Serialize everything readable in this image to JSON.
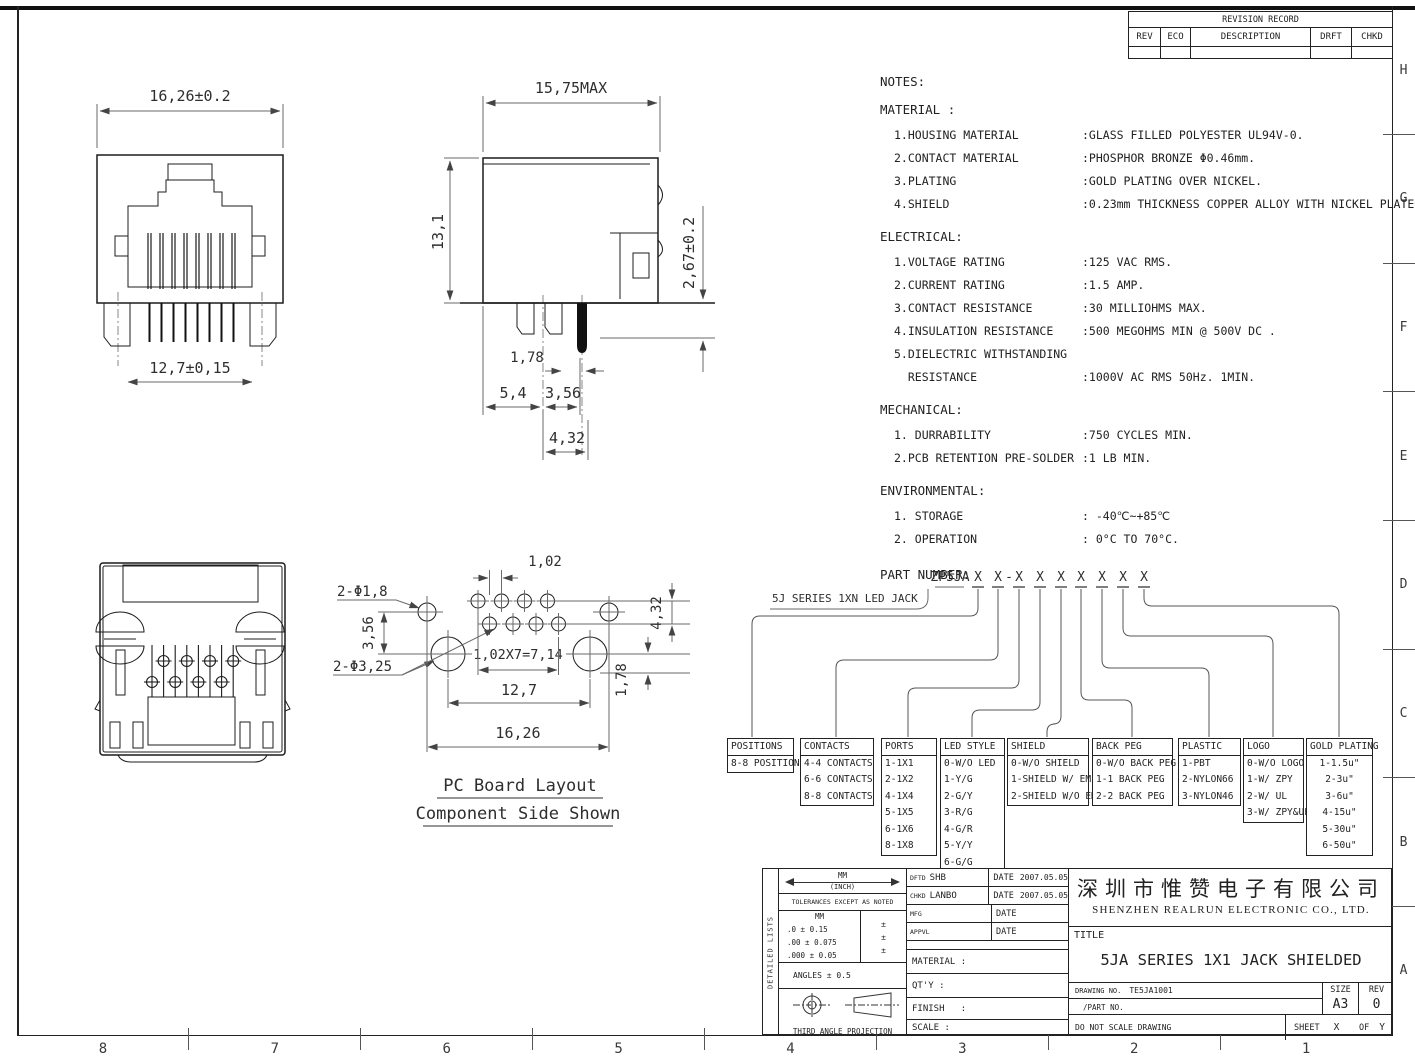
{
  "border": {
    "zone_letters": [
      "H",
      "G",
      "F",
      "E",
      "D",
      "C",
      "B",
      "A"
    ],
    "zone_numbers": [
      "8",
      "7",
      "6",
      "5",
      "4",
      "3",
      "2",
      "1"
    ]
  },
  "revision_table": {
    "title": "REVISION RECORD",
    "headers": [
      "REV",
      "ECO",
      "DESCRIPTION",
      "DRFT",
      "CHKD"
    ]
  },
  "front_view": {
    "top": "16,26±0.2",
    "bottom": "12,7±0,15"
  },
  "side_view": {
    "depth": "15,75MAX",
    "height": "13,1",
    "standoff": "2,67±0.2",
    "pin": "1,78",
    "a": "5,4",
    "b": "3,56",
    "c": "4,32"
  },
  "pcb_layout": {
    "title": "PC Board Layout",
    "subtitle": "Component Side Shown",
    "hole_small": "2-Φ1,8",
    "hole_big": "2-Φ3,25",
    "pitch": "1,02",
    "row_offset": "3,56",
    "span": "1,02X7=7,14",
    "centers": "12,7",
    "overall": "16,26",
    "v1": "4,32",
    "v2": "1,78"
  },
  "notes": {
    "heading": "NOTES:",
    "material": {
      "title": "MATERIAL :",
      "rows": [
        {
          "label": "1.HOUSING MATERIAL",
          "value": ":GLASS FILLED POLYESTER UL94V-0."
        },
        {
          "label": "2.CONTACT MATERIAL",
          "value": ":PHOSPHOR BRONZE Φ0.46mm."
        },
        {
          "label": "3.PLATING",
          "value": ":GOLD PLATING OVER NICKEL."
        },
        {
          "label": "4.SHIELD",
          "value": ":0.23mm THICKNESS COPPER ALLOY WITH NICKEL PLATED."
        }
      ]
    },
    "electrical": {
      "title": "ELECTRICAL:",
      "rows": [
        {
          "label": "1.VOLTAGE RATING",
          "value": ":125 VAC RMS."
        },
        {
          "label": "2.CURRENT RATING",
          "value": ":1.5 AMP."
        },
        {
          "label": "3.CONTACT RESISTANCE",
          "value": ":30 MILLIOHMS MAX."
        },
        {
          "label": "4.INSULATION RESISTANCE",
          "value": ":500 MEGOHMS MIN @ 500V DC ."
        },
        {
          "label": "5.DIELECTRIC WITHSTANDING",
          "value": ""
        },
        {
          "label": "  RESISTANCE",
          "value": ":1000V AC RMS 50Hz. 1MIN."
        }
      ]
    },
    "mechanical": {
      "title": "MECHANICAL:",
      "rows": [
        {
          "label": "1. DURRABILITY",
          "value": ":750 CYCLES MIN."
        },
        {
          "label": "2.PCB RETENTION PRE-SOLDER",
          "value": ":1 LB MIN."
        }
      ]
    },
    "environmental": {
      "title": "ENVIRONMENTAL:",
      "rows": [
        {
          "label": "1. STORAGE",
          "value": ": -40℃~+85℃"
        },
        {
          "label": "2. OPERATION",
          "value": ": 0°C TO 70°C."
        }
      ]
    },
    "part_number_heading": "PART NUMBER:"
  },
  "part_number": {
    "series_label": "5J SERIES 1XN LED JACK",
    "prefix": "ZP5JA",
    "placeholder": "X",
    "separator": "-",
    "boxes": [
      {
        "title": "POSITIONS",
        "items": [
          "8-8 POSITIONS"
        ]
      },
      {
        "title": "CONTACTS",
        "items": [
          "4-4 CONTACTS",
          "6-6 CONTACTS",
          "8-8 CONTACTS"
        ]
      },
      {
        "title": "PORTS",
        "items": [
          "1-1X1",
          "2-1X2",
          "4-1X4",
          "5-1X5",
          "6-1X6",
          "8-1X8"
        ]
      },
      {
        "title": "LED STYLE",
        "items": [
          "0-W/O LED",
          "1-Y/G",
          "2-G/Y",
          "3-R/G",
          "4-G/R",
          "5-Y/Y",
          "6-G/G",
          "7-OTHERS"
        ]
      },
      {
        "title": "SHIELD",
        "items": [
          "0-W/O SHIELD",
          "1-SHIELD W/ EMI",
          "2-SHIELD W/O EMI"
        ]
      },
      {
        "title": "BACK PEG",
        "items": [
          "0-W/O BACK PEG",
          "1-1 BACK PEG",
          "2-2 BACK PEG"
        ]
      },
      {
        "title": "PLASTIC",
        "items": [
          "1-PBT",
          "2-NYLON66",
          "3-NYLON46"
        ]
      },
      {
        "title": "LOGO",
        "items": [
          "0-W/O LOGO",
          "1-W/ ZPY",
          "2-W/ UL",
          "3-W/ ZPY&UL"
        ]
      },
      {
        "title": "GOLD PLATING",
        "items": [
          "1-1.5u\"",
          "2-3u\"",
          "3-6u\"",
          "4-15u\"",
          "5-30u\"",
          "6-50u\""
        ]
      }
    ]
  },
  "title_block": {
    "detailed_lists": "DETAILED LISTS",
    "units_mm": "MM",
    "units_inch": "(INCH)",
    "tolerances_heading": "TOLERANCES EXCEPT AS NOTED",
    "tol_col": "MM",
    "tol_rows": [
      ".0 ± 0.15",
      ".00 ± 0.075",
      ".000 ± 0.05"
    ],
    "tol_pm_rows": [
      "±",
      "±",
      "±"
    ],
    "angles": "ANGLES ± 0.5",
    "projection": "THIRD ANGLE PROJECTION",
    "sign_rows": [
      {
        "role": "DFTD",
        "name": "SHB",
        "date_label": "DATE",
        "date": "2007.05.05"
      },
      {
        "role": "CHKD",
        "name": "LANBO",
        "date_label": "DATE",
        "date": "2007.05.05"
      },
      {
        "role": "MFG",
        "name": "",
        "date_label": "DATE",
        "date": ""
      },
      {
        "role": "APPVL",
        "name": "",
        "date_label": "DATE",
        "date": ""
      }
    ],
    "material_label": "MATERIAL :",
    "qty_label": "QT'Y :",
    "finish_label": "FINISH   :",
    "scale_label": "SCALE :",
    "company_cn": "深圳市惟赞电子有限公司",
    "company_en": "SHENZHEN REALRUN ELECTRONIC CO., LTD.",
    "title_label": "TITLE",
    "title": "5JA SERIES 1X1 JACK SHIELDED",
    "drawing_no_label": "DRAWING NO.",
    "drawing_no": "TE5JA1001",
    "part_no_label": "/PART NO.",
    "size_label": "SIZE",
    "size": "A3",
    "rev_label": "REV",
    "rev": "0",
    "no_scale": "DO NOT SCALE DRAWING",
    "sheet_label": "SHEET",
    "sheet_x": "X",
    "of_label": "OF",
    "sheet_y": "Y"
  }
}
